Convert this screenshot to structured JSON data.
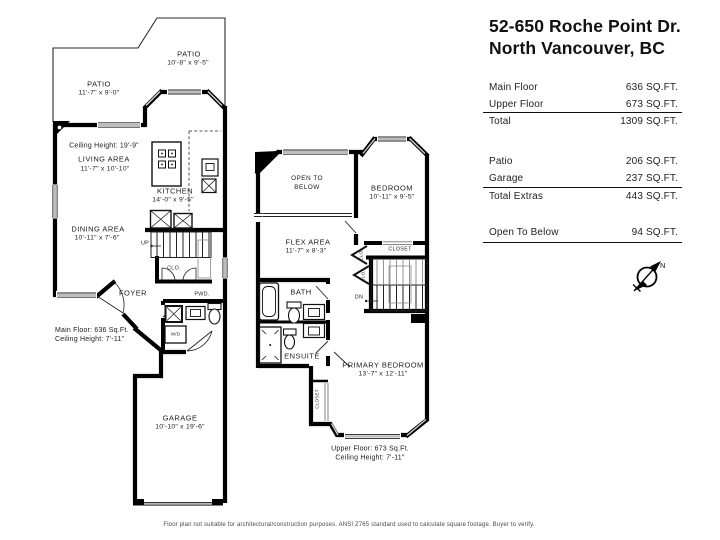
{
  "header": {
    "title_line1": "52-650 Roche Point Dr.",
    "title_line2": "North Vancouver, BC"
  },
  "summary": {
    "rows": [
      {
        "label": "Main Floor",
        "value": "636 SQ.FT."
      },
      {
        "label": "Upper Floor",
        "value": "673 SQ.FT."
      },
      {
        "label": "Total",
        "value": "1309 SQ.FT."
      },
      {
        "label": "Patio",
        "value": "206 SQ.FT."
      },
      {
        "label": "Garage",
        "value": "237 SQ.FT."
      },
      {
        "label": "Total Extras",
        "value": "443 SQ.FT."
      },
      {
        "label": "Open To Below",
        "value": "94 SQ.FT."
      }
    ],
    "compass_label": "N"
  },
  "main_floor": {
    "patio_upper_name": "PATIO",
    "patio_upper_dims": "10'-8\" x 9'-5\"",
    "patio_lower_name": "PATIO",
    "patio_lower_dims": "11'-7\" x 9'-0\"",
    "ceiling_note": "Ceiling Height: 19'-9\"",
    "living_name": "LIVING AREA",
    "living_dims": "11'-7\" x 10'-10\"",
    "kitchen_name": "KITCHEN",
    "kitchen_dims": "14'-0\" x 9'-5\"",
    "dining_name": "DINING AREA",
    "dining_dims": "10'-11\" x 7'-6\"",
    "up_label": "UP",
    "closet_label": "CLO.",
    "foyer_label": "FOYER",
    "powder_label": "PWD.",
    "washer_dryer_label": "W/D",
    "footer_line1": "Main Floor: 636 Sq.Ft.",
    "footer_line2": "Ceiling Height: 7'-11\"",
    "garage_name": "GARAGE",
    "garage_dims": "10'-10\" x 19'-6\""
  },
  "upper_floor": {
    "open_below_line1": "OPEN TO",
    "open_below_line2": "BELOW",
    "bedroom_name": "BEDROOM",
    "bedroom_dims": "10'-11\" x 9'-5\"",
    "flex_name": "FLEX AREA",
    "flex_dims": "11'-7\" x 8'-3\"",
    "bedroom_closet_label": "CLOSET",
    "clo1_label": "CLO.",
    "clo2_label": "CLO.",
    "bath_label": "BATH",
    "dn_label": "DN",
    "ensuite_label": "ENSUITE",
    "primary_name": "PRIMARY BEDROOM",
    "primary_dims": "13'-7\" x 12'-11\"",
    "primary_closet_label": "CLOSET",
    "footer_line1": "Upper Floor: 673 Sq.Ft.",
    "footer_line2": "Ceiling Height: 7'-11\""
  },
  "disclaimer": "Floor plan not suitable for architectural/construction purposes. ANSI Z765 standard used to calculate square footage. Buyer to verify.",
  "colors": {
    "wall": "#000000",
    "window": "#bdbdbd",
    "text": "#1c1c1c"
  }
}
